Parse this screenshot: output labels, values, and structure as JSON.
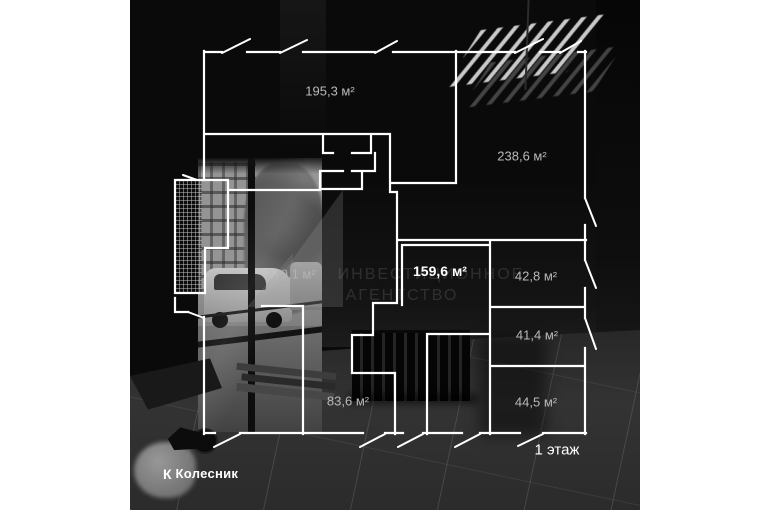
{
  "plan": {
    "rooms": [
      {
        "name": "room-195",
        "area_label": "195,3 м²"
      },
      {
        "name": "room-238",
        "area_label": "238,6 м²"
      },
      {
        "name": "room-279",
        "area_label": "279,1 м²"
      },
      {
        "name": "room-159",
        "area_label": "159,6 м²"
      },
      {
        "name": "room-42",
        "area_label": "42,8 м²"
      },
      {
        "name": "room-41",
        "area_label": "41,4 м²"
      },
      {
        "name": "room-83",
        "area_label": "83,6 м²"
      },
      {
        "name": "room-44",
        "area_label": "44,5 м²"
      }
    ],
    "floor_label": "1 этаж",
    "line_color": "#ffffff",
    "label_color": "#b9b9b9",
    "highlight_label_color": "#ffffff"
  },
  "watermark": {
    "line1": "ИНВЕСТИЦИОННОЕ",
    "line2": "АГЕНТСТВО"
  },
  "branding": {
    "logo_mark": "К",
    "logo_text": "Колесник"
  }
}
